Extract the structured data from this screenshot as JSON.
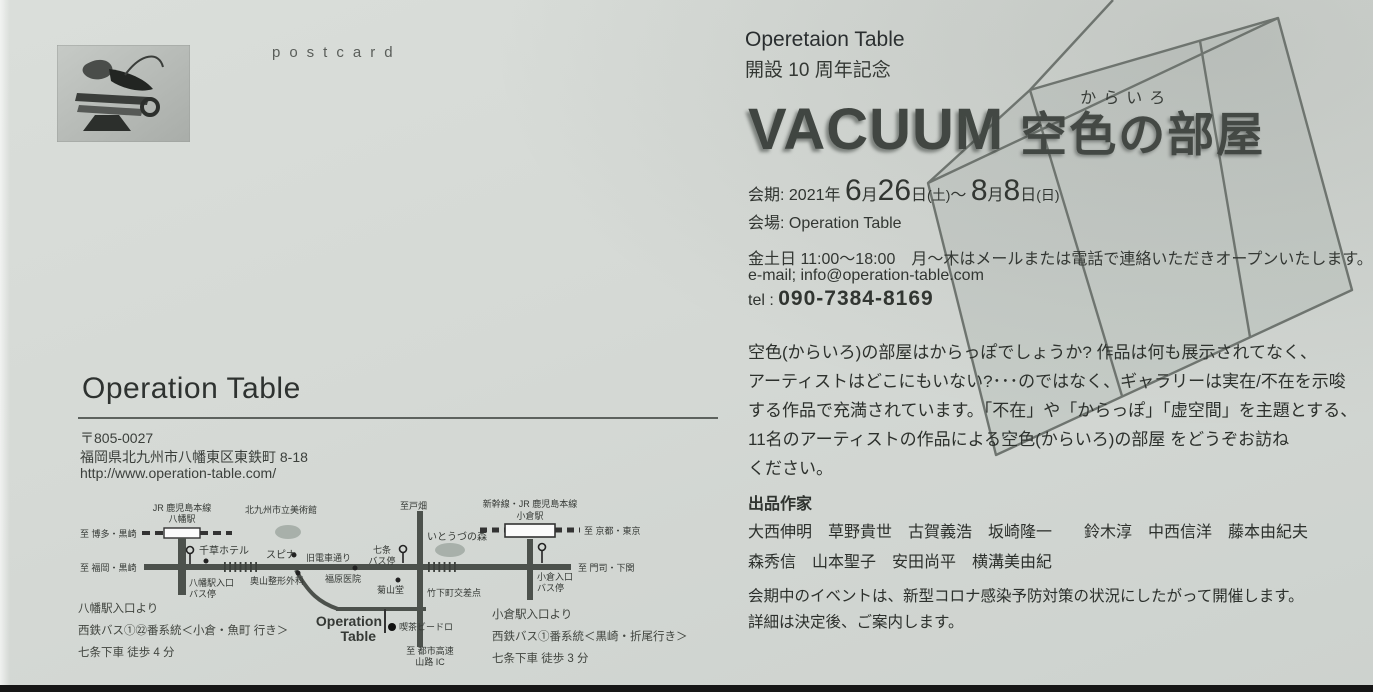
{
  "card": {
    "postcard_label": "postcard"
  },
  "header": {
    "org": "Operetaion Table",
    "anniv": "開設 10 周年記念",
    "title_en": "VACUUM",
    "furigana": "からいろ",
    "title_jp": "空色の部屋"
  },
  "details": {
    "dates": {
      "prefix": "会期: 2021年",
      "n1": "6",
      "u1": "月",
      "n2": "26",
      "u2": "日",
      "p1": "(土)",
      "tilde": "～",
      "n3": "8",
      "u3": "月",
      "n4": "8",
      "u4": "日",
      "p2": "(日)"
    },
    "venue_line": "会場: Operation Table",
    "hours": "金土日 11:00～18:00　月～木はメールまたは電話で連絡いただきオープンいたします。",
    "email": "e-mail; info@operation-table.com",
    "tel_label": "tel : ",
    "tel_number": "090-7384-8169"
  },
  "statement": {
    "lines": [
      "空色(からいろ)の部屋はからっぽでしょうか? 作品は何も展示されてなく、",
      "アーティストはどこにもいない?･･･のではなく、ギャラリーは実在/不在を示唆",
      "する作品で充満されています。「不在」や「からっぽ」「虚空間」を主題とする、",
      "11名のアーティストの作品による空色(からいろ)の部屋 をどうぞお訪ね",
      "ください。"
    ]
  },
  "artists": {
    "heading": "出品作家",
    "row1": "大西伸明　草野貴世　古賀義浩　坂崎隆一　　鈴木淳　中西信洋　藤本由紀夫",
    "row2": "森秀信　山本聖子　安田尚平　横溝美由紀"
  },
  "notice": {
    "line1": "会期中のイベントは、新型コロナ感染予防対策の状況にしたがって開催します。",
    "line2": "詳細は決定後、ご案内します。"
  },
  "venue": {
    "name": "Operation Table",
    "postal": "〒805-0027",
    "address": "福岡県北九州市八幡東区東鉄町 8-18",
    "url": "http://www.operation-table.com/"
  },
  "map": {
    "rail_left_dest": "至 博多・黒崎",
    "jr_line": "JR 鹿児島本線",
    "yahata_sta": "八幡駅",
    "museum": "北九州市立美術館",
    "road_left_dest": "至 福岡・黒崎",
    "chigusa_hotel": "千草ホテル",
    "yahata_bus1": "八幡駅入口",
    "yahata_bus2": "バス停",
    "spina": "スピナ",
    "kyudensha": "旧電車通り",
    "okuyama": "奥山整形外科",
    "fukuhara": "福原医院",
    "shichijo1": "七条",
    "shichijo2": "バス停",
    "tobata": "至戸畑",
    "itozu": "いとうづの森",
    "kikusando": "菊山堂",
    "takeshita": "竹下町交差点",
    "shinkansen": "新幹線・JR 鹿児島本線",
    "kokura_sta": "小倉駅",
    "kyoto_tokyo": "至 京都・東京",
    "moji": "至 門司・下関",
    "kokura_bus1": "小倉入口",
    "kokura_bus2": "バス停",
    "op1": "Operation",
    "op2": "Table",
    "vidro": "喫茶ビードロ",
    "expressway1": "至 都市高速",
    "expressway2": "山路 IC"
  },
  "access": {
    "left1": "八幡駅入口より",
    "left2": "西鉄バス①㉒番系統＜小倉・魚町 行き＞",
    "left3": "七条下車 徒歩 4 分",
    "right1": "小倉駅入口より",
    "right2": "西鉄バス①番系統＜黒崎・折尾行き＞",
    "right3": "七条下車 徒歩 3 分"
  },
  "colors": {
    "background": "#d5d9d5",
    "ink": "#2f332f",
    "cube_line": "#6e746f"
  }
}
